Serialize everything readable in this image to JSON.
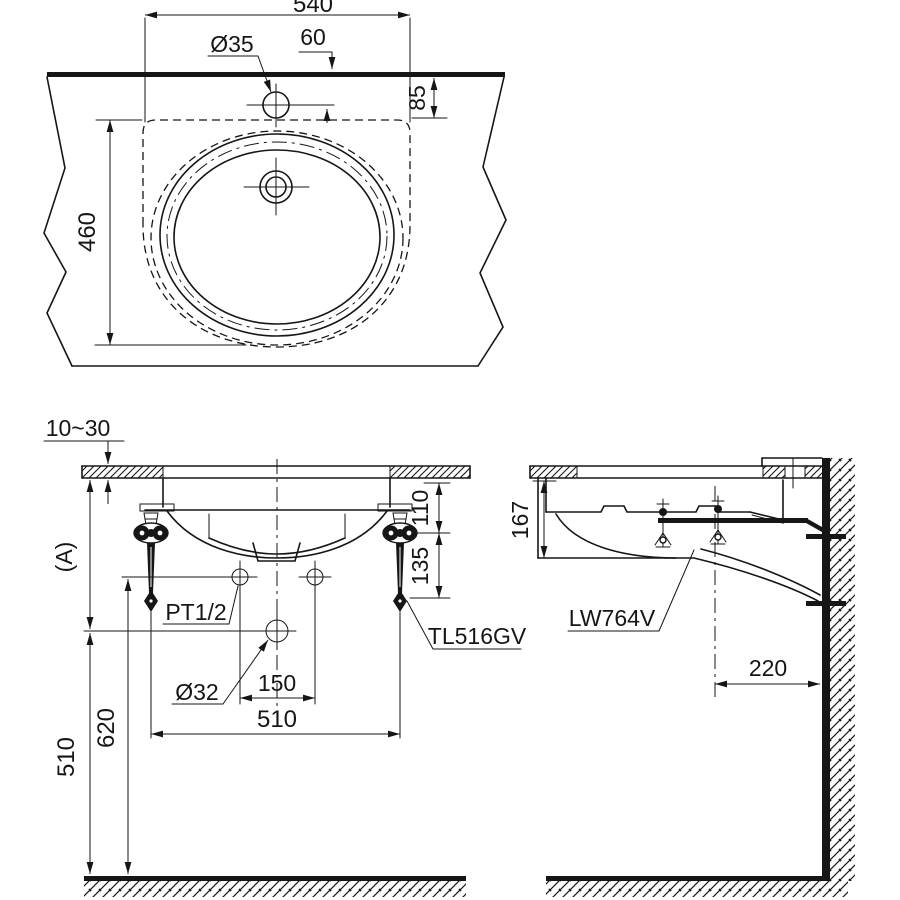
{
  "drawing": {
    "top_view": {
      "width": "540",
      "faucet_hole_dia": "Ø35",
      "faucet_offset": "60",
      "edge_to_cutout": "85",
      "depth": "460"
    },
    "front_view": {
      "counter_thickness": "10~30",
      "counter_height": "(A)",
      "counter_to_valve": "110",
      "valve_length": "135",
      "supply_type": "PT1/2",
      "faucet_model": "TL516GV",
      "drain_dia": "Ø32",
      "supply_spacing": "150",
      "valve_spacing": "510",
      "supply_height": "620",
      "drain_height": "510"
    },
    "side_view": {
      "basin_depth": "167",
      "basin_model": "LW764V",
      "drain_to_wall": "220"
    }
  }
}
